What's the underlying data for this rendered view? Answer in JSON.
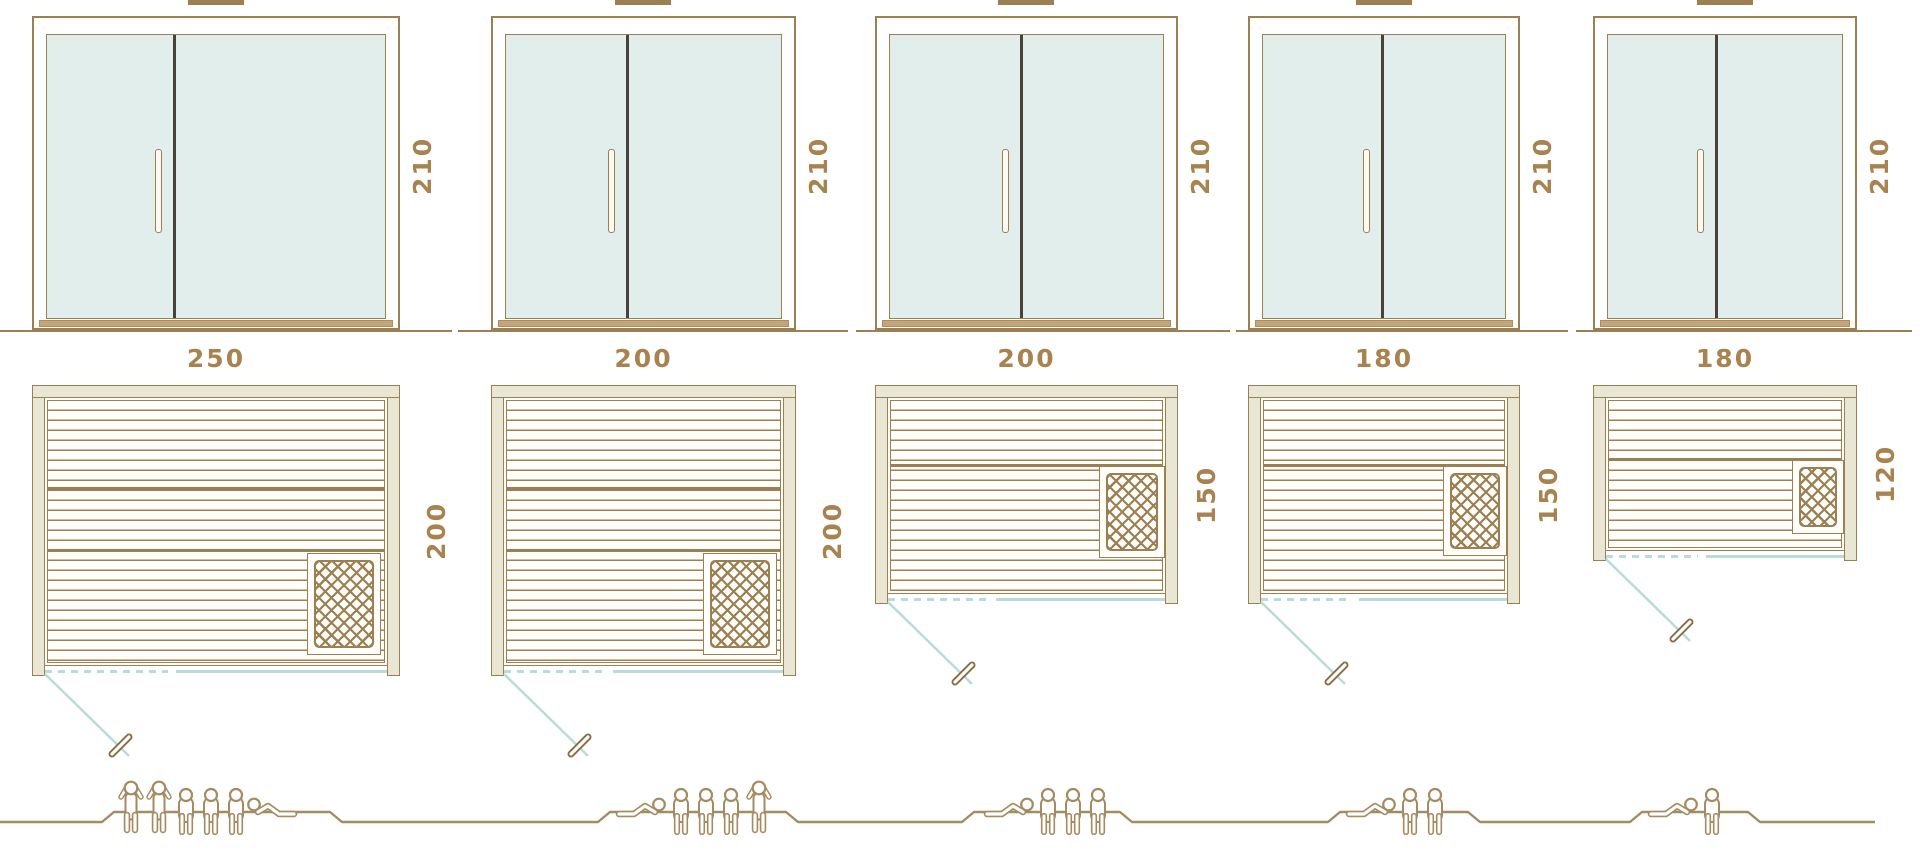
{
  "diagram": {
    "type": "sauna-size-comparison",
    "units": [
      {
        "elevation_height_cm": "210",
        "plan_width_cm": "250",
        "plan_depth_cm": "200",
        "capacity": {
          "standing": 2,
          "sitting": 3,
          "reclining": 1
        }
      },
      {
        "elevation_height_cm": "210",
        "plan_width_cm": "200",
        "plan_depth_cm": "200",
        "capacity": {
          "standing": 1,
          "sitting": 3,
          "reclining": 1
        }
      },
      {
        "elevation_height_cm": "210",
        "plan_width_cm": "200",
        "plan_depth_cm": "150",
        "capacity": {
          "standing": 0,
          "sitting": 3,
          "reclining": 1
        }
      },
      {
        "elevation_height_cm": "210",
        "plan_width_cm": "180",
        "plan_depth_cm": "150",
        "capacity": {
          "standing": 0,
          "sitting": 2,
          "reclining": 1
        }
      },
      {
        "elevation_height_cm": "210",
        "plan_width_cm": "180",
        "plan_depth_cm": "120",
        "capacity": {
          "standing": 0,
          "sitting": 1,
          "reclining": 1
        }
      }
    ]
  },
  "colors": {
    "brown": "#9d8052",
    "beige": "#e9e7d3",
    "glass": "#e1eeec",
    "teal": "#b9dcd9",
    "label": "#a8834f",
    "figure": "#a58b61",
    "dark": "#4a4238",
    "sill": "#c6a379"
  }
}
